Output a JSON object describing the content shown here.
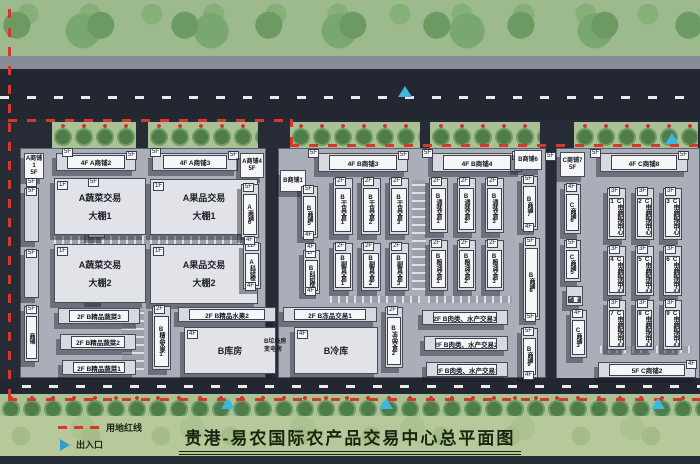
{
  "title": "贵港-易农国际农产品交易中心总平面图",
  "legend": {
    "red_line": "用地红线",
    "entrance": "出入口"
  },
  "colors": {
    "boundary_red": "#d43a2c",
    "entrance_cyan": "#3fb6dc",
    "road": "#222732",
    "building": "#d6d9df",
    "green_belt": "#9cba8e",
    "legend_bg": "#b7c99b"
  },
  "buildings": [
    {
      "name": "A商铺1",
      "floor": "5F",
      "type": "tower",
      "x": 24,
      "y": 153,
      "w": 20,
      "h": 26
    },
    {
      "name": "A商铺2",
      "floor": "4F",
      "type": "bar",
      "x": 56,
      "y": 153,
      "w": 80,
      "h": 18,
      "end": "5F"
    },
    {
      "name": "A商铺3",
      "floor": "4F",
      "type": "bar",
      "x": 152,
      "y": 153,
      "w": 86,
      "h": 18,
      "end": "5F"
    },
    {
      "name": "A商铺4",
      "floor": "5F",
      "type": "tower",
      "x": 240,
      "y": 153,
      "w": 24,
      "h": 25
    },
    {
      "name": "",
      "floor": "5F",
      "type": "vbar",
      "x": 24,
      "y": 188,
      "w": 15,
      "h": 54
    },
    {
      "name": "",
      "floor": "5F",
      "type": "vbar",
      "x": 24,
      "y": 250,
      "w": 15,
      "h": 48
    },
    {
      "name": "商铺",
      "floor": "5F",
      "type": "vbar",
      "x": 24,
      "y": 306,
      "w": 15,
      "h": 56
    },
    {
      "name": "A商铺5",
      "floor": "5F",
      "type": "vbar",
      "x": 88,
      "y": 188,
      "w": 17,
      "h": 50
    },
    {
      "name": "A生活区",
      "floor": "",
      "type": "vbar",
      "x": 88,
      "y": 252,
      "w": 17,
      "h": 50
    },
    {
      "name": "A蔬菜交易\n大棚1",
      "floor": "1F",
      "type": "shed",
      "x": 54,
      "y": 178,
      "w": 92,
      "h": 57
    },
    {
      "name": "A蔬菜交易\n大棚2",
      "floor": "1F",
      "type": "shed",
      "x": 54,
      "y": 244,
      "w": 92,
      "h": 59
    },
    {
      "name": "A果品交易\n大棚1",
      "floor": "1F",
      "type": "shed",
      "x": 150,
      "y": 179,
      "w": 108,
      "h": 56
    },
    {
      "name": "A果品交易\n大棚2",
      "floor": "1F",
      "type": "shed",
      "x": 150,
      "y": 244,
      "w": 108,
      "h": 60
    },
    {
      "name": "A商铺6",
      "floor": "5F",
      "type": "vbar",
      "x": 241,
      "y": 184,
      "w": 18,
      "h": 54
    },
    {
      "name": "A科研楼",
      "floor": "11F",
      "type": "vbar",
      "x": 243,
      "y": 243,
      "w": 18,
      "h": 46,
      "end": "4F"
    },
    {
      "name": "B精品蔬菜3",
      "floor": "2F",
      "type": "bar",
      "x": 58,
      "y": 308,
      "w": 82,
      "h": 16
    },
    {
      "name": "B精品蔬菜2",
      "floor": "2F",
      "type": "bar",
      "x": 60,
      "y": 334,
      "w": 76,
      "h": 16
    },
    {
      "name": "B精品蔬菜1",
      "floor": "2F",
      "type": "bar",
      "x": 62,
      "y": 360,
      "w": 74,
      "h": 15
    },
    {
      "name": "B精品水果1",
      "floor": "2F",
      "type": "vbar",
      "x": 152,
      "y": 306,
      "w": 19,
      "h": 64
    },
    {
      "name": "B精品水果2",
      "floor": "2F",
      "type": "bar",
      "x": 178,
      "y": 307,
      "w": 98,
      "h": 15
    },
    {
      "name": "B库房",
      "floor": "4F",
      "type": "shed",
      "x": 184,
      "y": 327,
      "w": 92,
      "h": 47
    },
    {
      "name": "B垃圾房\n变电房",
      "floor": "",
      "type": "note",
      "x": 264,
      "y": 338,
      "w": 34,
      "h": 22
    },
    {
      "name": "B商铺1",
      "floor": "",
      "type": "tower",
      "x": 280,
      "y": 170,
      "w": 26,
      "h": 22
    },
    {
      "name": "B商铺5",
      "floor": "5F",
      "type": "vbar",
      "x": 301,
      "y": 186,
      "w": 17,
      "h": 52,
      "end": "4F"
    },
    {
      "name": "B科研楼",
      "floor": "1F",
      "type": "vbar",
      "x": 303,
      "y": 250,
      "w": 17,
      "h": 44,
      "end": "4F"
    },
    {
      "name": "B商铺3",
      "floor": "4F",
      "type": "bar",
      "x": 318,
      "y": 153,
      "w": 90,
      "h": 19,
      "end": "5F"
    },
    {
      "name": "B干货交易1",
      "floor": "2F",
      "type": "vbar",
      "x": 333,
      "y": 178,
      "w": 20,
      "h": 57
    },
    {
      "name": "B干货交易2",
      "floor": "2F",
      "type": "vbar",
      "x": 361,
      "y": 178,
      "w": 20,
      "h": 57
    },
    {
      "name": "B干货交易3",
      "floor": "2F",
      "type": "vbar",
      "x": 389,
      "y": 178,
      "w": 20,
      "h": 57
    },
    {
      "name": "B副食交易1",
      "floor": "2F",
      "type": "vbar",
      "x": 333,
      "y": 243,
      "w": 20,
      "h": 48
    },
    {
      "name": "B副食交易2",
      "floor": "2F",
      "type": "vbar",
      "x": 361,
      "y": 243,
      "w": 20,
      "h": 48
    },
    {
      "name": "B副食交易3",
      "floor": "2F",
      "type": "vbar",
      "x": 389,
      "y": 243,
      "w": 20,
      "h": 48
    },
    {
      "name": "B冻品交易1",
      "floor": "2F",
      "type": "bar",
      "x": 283,
      "y": 307,
      "w": 94,
      "h": 15
    },
    {
      "name": "B冷库",
      "floor": "4F",
      "type": "shed",
      "x": 294,
      "y": 327,
      "w": 84,
      "h": 47
    },
    {
      "name": "B冻品交易2",
      "floor": "2F",
      "type": "vbar",
      "x": 385,
      "y": 307,
      "w": 18,
      "h": 61
    },
    {
      "name": "B商铺4",
      "floor": "4F",
      "type": "bar",
      "x": 432,
      "y": 153,
      "w": 90,
      "h": 19,
      "end": "5F"
    },
    {
      "name": "B调味交易1",
      "floor": "2F",
      "type": "vbar",
      "x": 429,
      "y": 178,
      "w": 19,
      "h": 55
    },
    {
      "name": "B调味交易2",
      "floor": "2F",
      "type": "vbar",
      "x": 457,
      "y": 178,
      "w": 19,
      "h": 55
    },
    {
      "name": "B调味交易3",
      "floor": "2F",
      "type": "vbar",
      "x": 485,
      "y": 178,
      "w": 19,
      "h": 55
    },
    {
      "name": "B粮油交易1",
      "floor": "2F",
      "type": "vbar",
      "x": 429,
      "y": 240,
      "w": 19,
      "h": 51
    },
    {
      "name": "B粮油交易2",
      "floor": "2F",
      "type": "vbar",
      "x": 457,
      "y": 240,
      "w": 19,
      "h": 51
    },
    {
      "name": "B粮油交易3",
      "floor": "2F",
      "type": "vbar",
      "x": 485,
      "y": 240,
      "w": 19,
      "h": 51
    },
    {
      "name": "B肉类、水产交易3",
      "floor": "2F",
      "type": "bar",
      "x": 422,
      "y": 310,
      "w": 86,
      "h": 15
    },
    {
      "name": "B肉类、水产交易2",
      "floor": "2F",
      "type": "bar",
      "x": 424,
      "y": 336,
      "w": 84,
      "h": 15
    },
    {
      "name": "B肉类、水产交易1",
      "floor": "2F",
      "type": "bar",
      "x": 426,
      "y": 362,
      "w": 82,
      "h": 15
    },
    {
      "name": "B商铺6",
      "floor": "",
      "type": "tower",
      "x": 514,
      "y": 150,
      "w": 28,
      "h": 20
    },
    {
      "name": "B商铺7",
      "floor": "5F",
      "type": "vbar",
      "x": 521,
      "y": 176,
      "w": 17,
      "h": 54,
      "end": "4F"
    },
    {
      "name": "B商铺8",
      "floor": "5F",
      "type": "vbar",
      "x": 523,
      "y": 238,
      "w": 17,
      "h": 82,
      "end": "5F"
    },
    {
      "name": "B商铺9",
      "floor": "5F",
      "type": "vbar",
      "x": 521,
      "y": 328,
      "w": 17,
      "h": 50,
      "end": "4F"
    },
    {
      "name": "C商铺7",
      "floor": "5F",
      "type": "tower",
      "x": 560,
      "y": 152,
      "w": 25,
      "h": 25
    },
    {
      "name": "C商铺8",
      "floor": "4F",
      "type": "bar",
      "x": 600,
      "y": 153,
      "w": 88,
      "h": 19,
      "end": "5F"
    },
    {
      "name": "C商铺6",
      "floor": "4F",
      "type": "vbar",
      "x": 564,
      "y": 184,
      "w": 17,
      "h": 50
    },
    {
      "name": "C商铺5",
      "floor": "5F",
      "type": "vbar",
      "x": 564,
      "y": 240,
      "w": 17,
      "h": 42
    },
    {
      "name": "C商铺4",
      "floor": "",
      "type": "vbar",
      "x": 566,
      "y": 286,
      "w": 17,
      "h": 20
    },
    {
      "name": "C商铺3",
      "floor": "4F",
      "type": "vbar",
      "x": 570,
      "y": 310,
      "w": 17,
      "h": 48
    },
    {
      "name": "C商铺2",
      "floor": "5F",
      "type": "bar",
      "x": 598,
      "y": 362,
      "w": 98,
      "h": 16,
      "end": "4F"
    },
    {
      "name": "C电商配送中心1",
      "floor": "3F",
      "type": "vbar",
      "x": 607,
      "y": 188,
      "w": 19,
      "h": 52
    },
    {
      "name": "C电商配送中心2",
      "floor": "3F",
      "type": "vbar",
      "x": 635,
      "y": 188,
      "w": 19,
      "h": 52
    },
    {
      "name": "C电商配送中心3",
      "floor": "3F",
      "type": "vbar",
      "x": 663,
      "y": 188,
      "w": 19,
      "h": 52
    },
    {
      "name": "C电商配送中心4",
      "floor": "3F",
      "type": "vbar",
      "x": 607,
      "y": 246,
      "w": 19,
      "h": 50
    },
    {
      "name": "C电商配送中心5",
      "floor": "3F",
      "type": "vbar",
      "x": 635,
      "y": 246,
      "w": 19,
      "h": 50
    },
    {
      "name": "C电商配送中心6",
      "floor": "3F",
      "type": "vbar",
      "x": 663,
      "y": 246,
      "w": 19,
      "h": 50
    },
    {
      "name": "C电商配送中心7",
      "floor": "3F",
      "type": "vbar",
      "x": 607,
      "y": 300,
      "w": 19,
      "h": 50
    },
    {
      "name": "C电商配送中心8",
      "floor": "3F",
      "type": "vbar",
      "x": 635,
      "y": 300,
      "w": 19,
      "h": 50
    },
    {
      "name": "C电商配送中心9",
      "floor": "3F",
      "type": "vbar",
      "x": 663,
      "y": 300,
      "w": 19,
      "h": 50
    }
  ],
  "floor_chips": [
    {
      "t": "5F",
      "x": 62,
      "y": 148
    },
    {
      "t": "5F",
      "x": 150,
      "y": 148
    },
    {
      "t": "5F",
      "x": 88,
      "y": 178
    },
    {
      "t": "5F",
      "x": 308,
      "y": 149
    },
    {
      "t": "5F",
      "x": 422,
      "y": 149
    },
    {
      "t": "5F",
      "x": 590,
      "y": 149
    },
    {
      "t": "4F",
      "x": 244,
      "y": 236
    },
    {
      "t": "4F",
      "x": 305,
      "y": 243
    },
    {
      "t": "5F",
      "x": 545,
      "y": 152
    },
    {
      "t": "5F",
      "x": 26,
      "y": 178
    }
  ],
  "entrances": [
    {
      "x": 405,
      "y": 86
    },
    {
      "x": 672,
      "y": 133
    },
    {
      "x": 228,
      "y": 398
    },
    {
      "x": 386,
      "y": 398
    },
    {
      "x": 658,
      "y": 398
    }
  ]
}
